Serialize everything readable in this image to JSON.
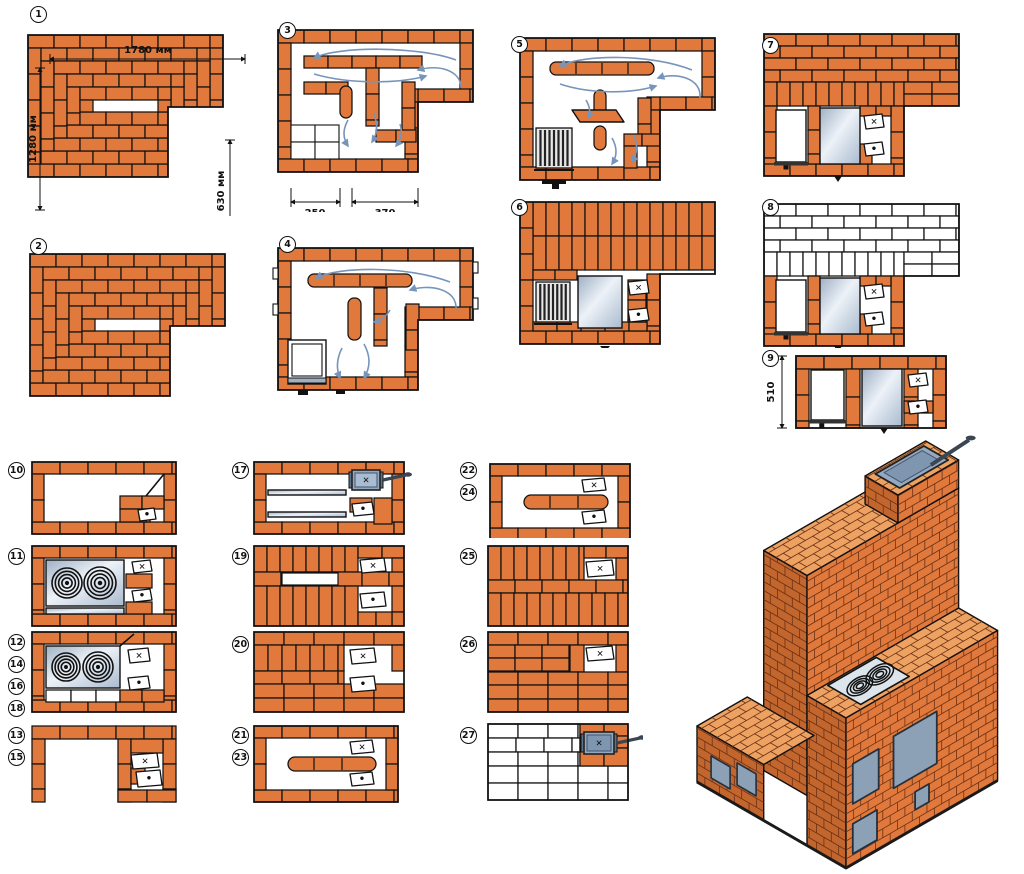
{
  "title": "Brick stove course-by-course masonry diagrams",
  "symbols": {
    "cleanout": "✕",
    "dot": "•"
  },
  "colors": {
    "brick": "#E0793B",
    "brick_light": "#EDA262",
    "brick_dark": "#C2662E",
    "outline": "#111111",
    "mortar": "#6b3116",
    "arrow": "#7795BA",
    "metal_light": "#EAF0F6",
    "metal": "#B9C7D8",
    "damper": "#93A9C2",
    "door_metal": "#8CA0B6",
    "white_brick": "#FFFFFF"
  },
  "tiles": {
    "t1": {
      "numbers": [
        "1"
      ],
      "dims": {
        "top": "1780 мм",
        "left": "1280 мм",
        "right": "630 мм",
        "bottom": "1280 мм"
      }
    },
    "t2": {
      "numbers": [
        "2"
      ]
    },
    "t3": {
      "numbers": [
        "3"
      ],
      "dims": {
        "a": "250",
        "b": "370"
      }
    },
    "t4": {
      "numbers": [
        "4"
      ]
    },
    "t5": {
      "numbers": [
        "5"
      ]
    },
    "t6": {
      "numbers": [
        "6"
      ]
    },
    "t7": {
      "numbers": [
        "7"
      ]
    },
    "t8": {
      "numbers": [
        "8"
      ]
    },
    "t9": {
      "numbers": [
        "9"
      ],
      "dims": {
        "left": "510"
      }
    },
    "t10": {
      "numbers": [
        "10"
      ]
    },
    "t11": {
      "numbers": [
        "11"
      ]
    },
    "t12": {
      "numbers": [
        "12",
        "14",
        "16",
        "18"
      ]
    },
    "t13": {
      "numbers": [
        "13",
        "15"
      ]
    },
    "t17": {
      "numbers": [
        "17"
      ]
    },
    "t19": {
      "numbers": [
        "19"
      ]
    },
    "t20": {
      "numbers": [
        "20"
      ]
    },
    "t21": {
      "numbers": [
        "21",
        "23"
      ]
    },
    "t22": {
      "numbers": [
        "22",
        "24"
      ]
    },
    "t25": {
      "numbers": [
        "25"
      ]
    },
    "t26": {
      "numbers": [
        "26"
      ]
    },
    "t27": {
      "numbers": [
        "27"
      ]
    }
  }
}
